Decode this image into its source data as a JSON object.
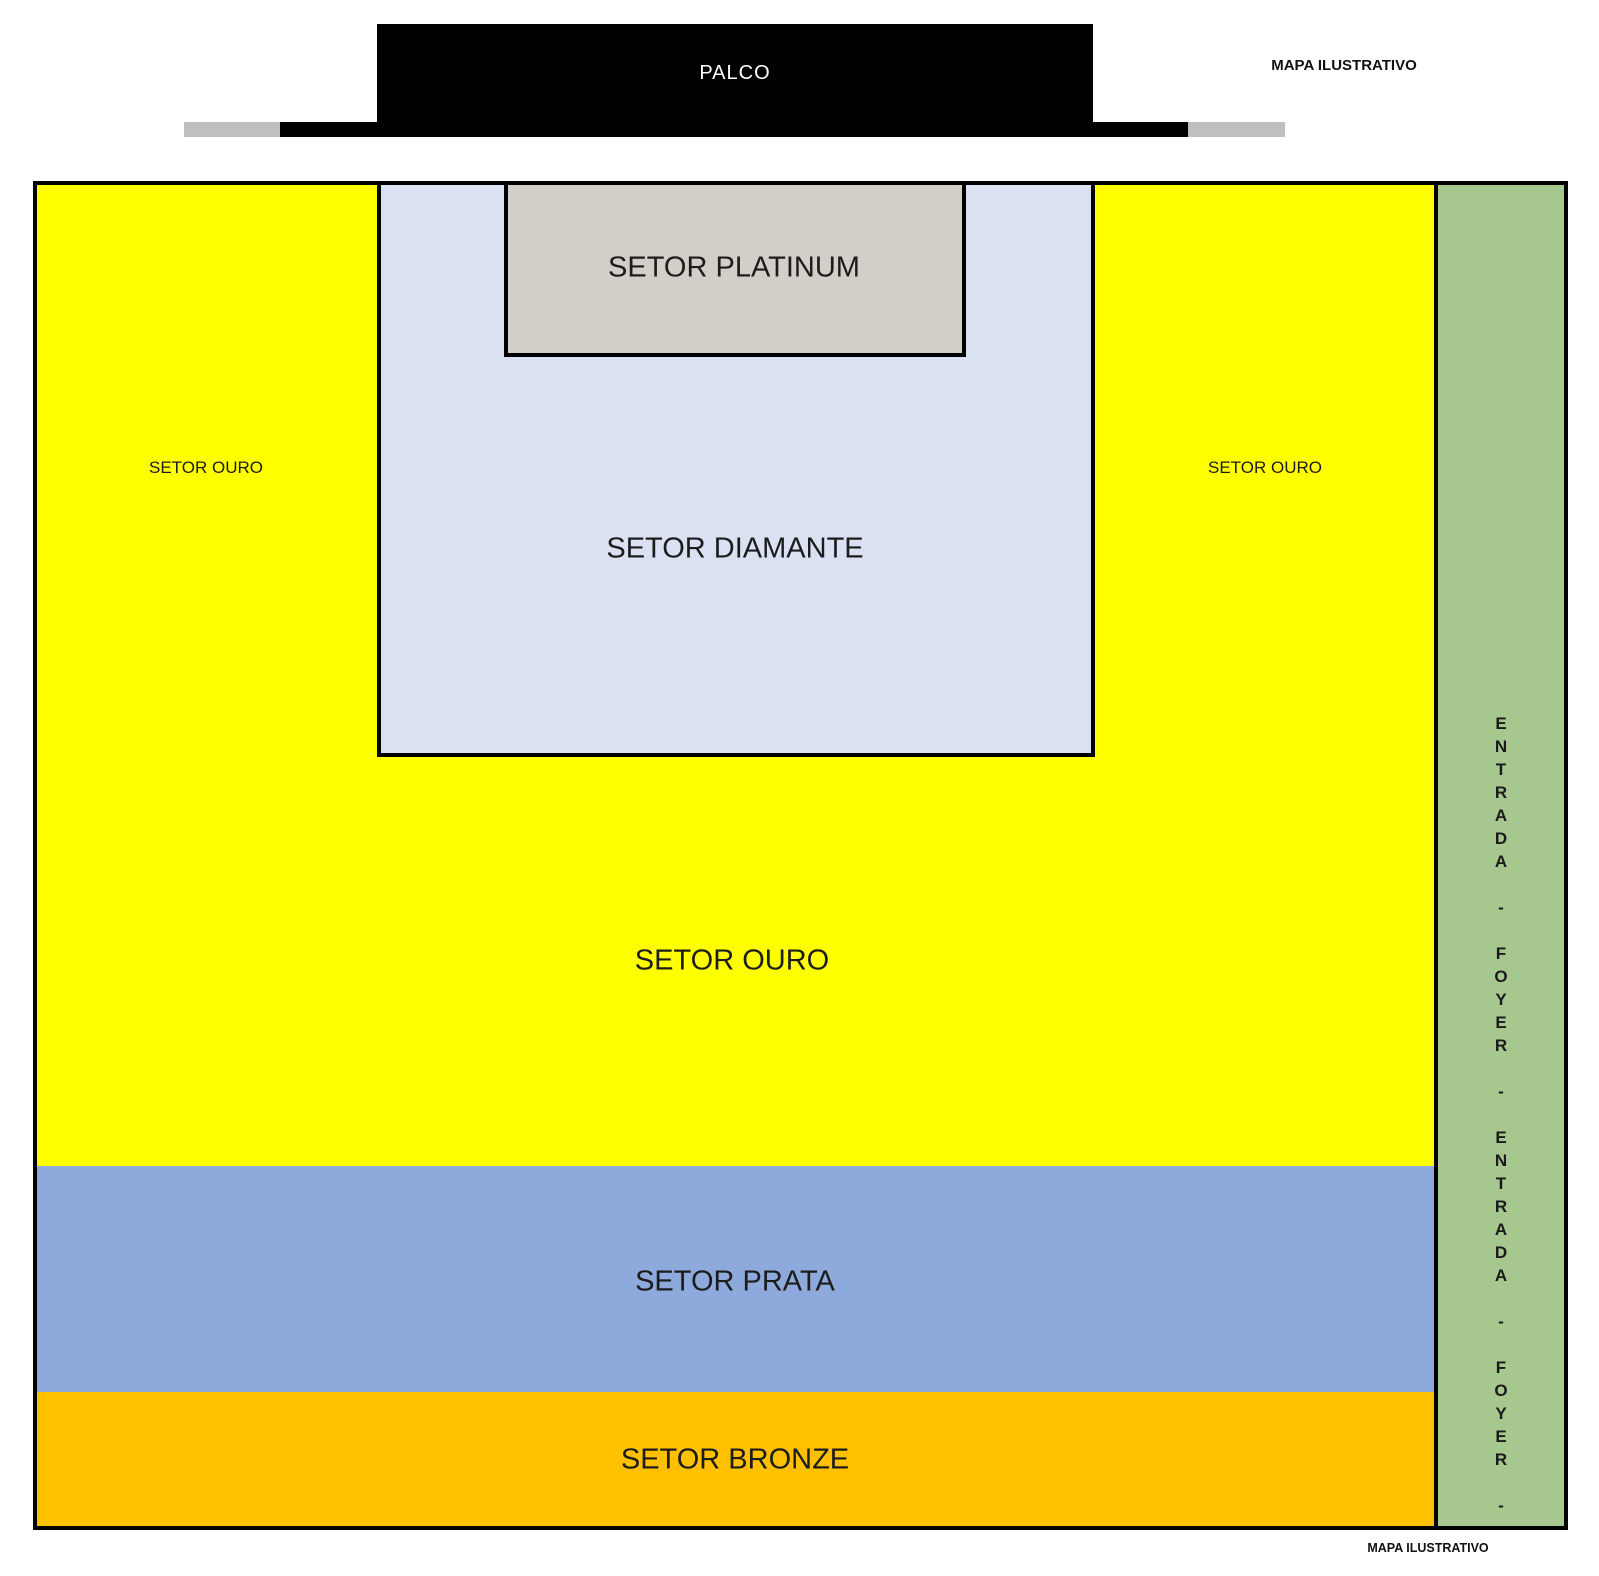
{
  "page": {
    "title_top": "MAPA ILUSTRATIVO",
    "title_bottom": "MAPA ILUSTRATIVO"
  },
  "stage": {
    "label": "PALCO",
    "color": "#000000",
    "wing_color": "#BFBFBF",
    "text_color": "#FFFFFF"
  },
  "sectors": {
    "platinum": {
      "label": "SETOR PLATINUM",
      "color": "#D3CFC8"
    },
    "diamante": {
      "label": "SETOR DIAMANTE",
      "color": "#D9E1F2"
    },
    "ouro": {
      "label": "SETOR OURO",
      "color": "#FFFF00"
    },
    "prata": {
      "label": "SETOR PRATA",
      "color": "#8EA9DB"
    },
    "bronze": {
      "label": "SETOR BRONZE",
      "color": "#FFC000"
    }
  },
  "entrance": {
    "vertical_text": "ENTRADA - FOYER - ENTRADA - FOYER -",
    "color": "#A6C78E"
  }
}
